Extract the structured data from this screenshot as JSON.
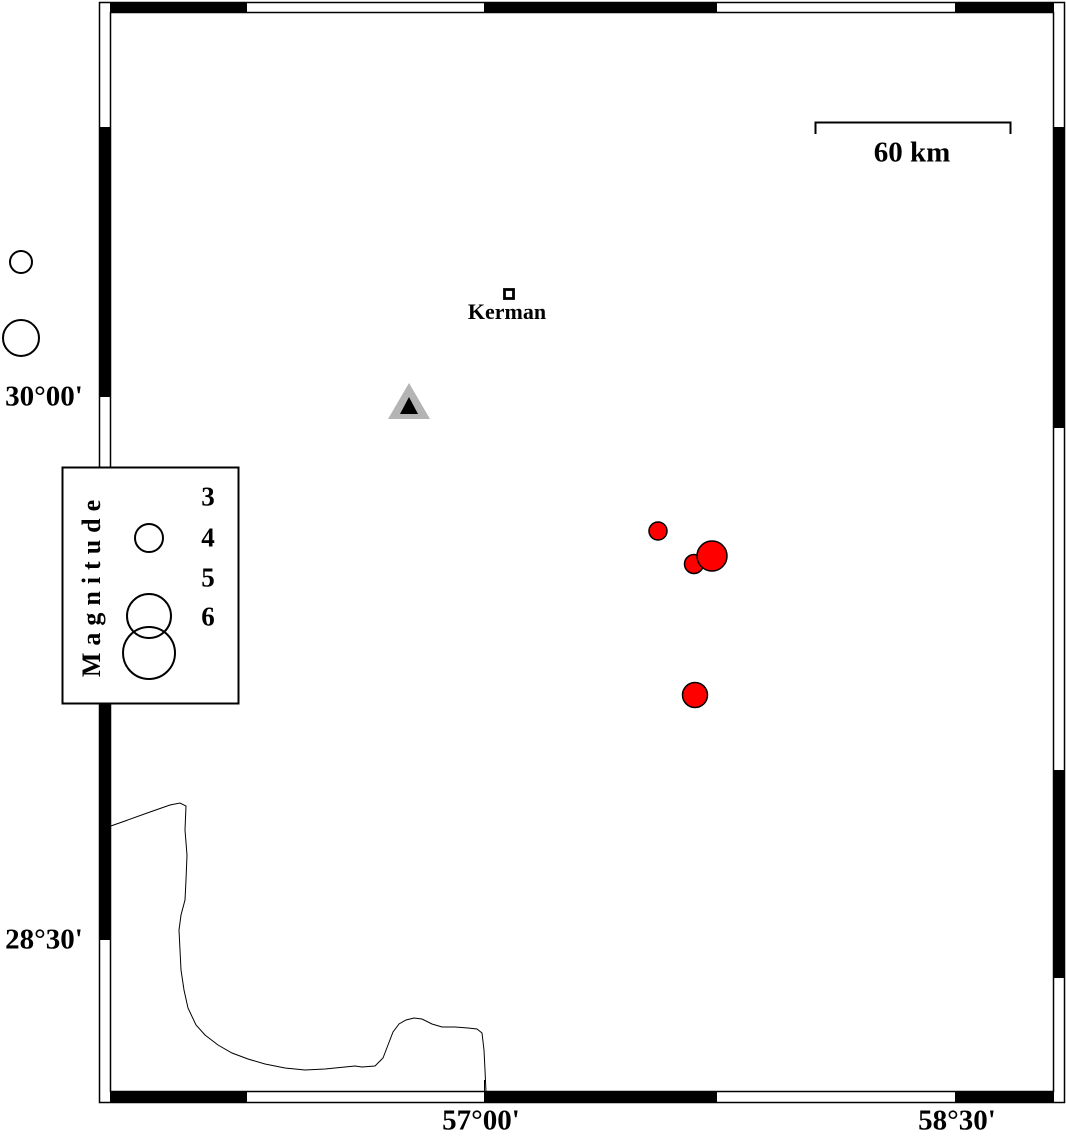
{
  "map": {
    "region_note": "seismicity map frame",
    "frame": {
      "inner": {
        "x": 110,
        "y": 12,
        "w": 944,
        "h": 1080
      },
      "outer": {
        "x": 99,
        "y": 2,
        "w": 966,
        "h": 1101
      }
    }
  },
  "axis": {
    "left_labels": [
      {
        "text": "30°00'",
        "x": 44,
        "y": 397
      },
      {
        "text": "28°30'",
        "x": 44,
        "y": 940
      }
    ],
    "bottom_labels": [
      {
        "text": "57°00'",
        "x": 481,
        "y": 1121
      },
      {
        "text": "58°30'",
        "x": 957,
        "y": 1121
      }
    ]
  },
  "scale_bar": {
    "label": "60 km",
    "label_pos": {
      "x": 912,
      "y": 153
    },
    "x1": 815,
    "x2": 1010,
    "y": 122,
    "tick_drop": 12
  },
  "city": {
    "name": "Kerman",
    "label": {
      "x": 507,
      "y": 312
    },
    "marker": {
      "x": 504.5,
      "y": 289.5,
      "size": 9
    }
  },
  "station": {
    "outer_points": "409,383 388,419 430,419",
    "inner_points": "409,397 400,414 418,414"
  },
  "legend": {
    "title": "Magnitude",
    "title_pos": {
      "x": 92,
      "y": 585
    },
    "box": {
      "x": 62.5,
      "y": 467.5,
      "w": 176,
      "h": 236
    },
    "entries": [
      {
        "label": "3",
        "x": 208,
        "y": 497
      },
      {
        "label": "4",
        "x": 208,
        "y": 538
      },
      {
        "label": "5",
        "x": 208,
        "y": 578
      },
      {
        "label": "6",
        "x": 208,
        "y": 617
      }
    ],
    "circles": [
      {
        "x": 149,
        "y": 538,
        "r": 14
      },
      {
        "x": 149,
        "y": 616,
        "r": 22
      },
      {
        "x": 149,
        "y": 653,
        "r": 26
      }
    ],
    "extra_circles": [
      {
        "x": 21,
        "y": 262,
        "r": 11
      },
      {
        "x": 21,
        "y": 338,
        "r": 18
      }
    ]
  },
  "earthquakes": [
    {
      "x": 658,
      "y": 531,
      "r": 9
    },
    {
      "x": 694,
      "y": 564,
      "r": 9.5
    },
    {
      "x": 712,
      "y": 556,
      "r": 15
    },
    {
      "x": 695,
      "y": 695,
      "r": 12.5
    }
  ],
  "coastline": [
    [
      108,
      827
    ],
    [
      125,
      821
    ],
    [
      150,
      812
    ],
    [
      170,
      805
    ],
    [
      180,
      803
    ],
    [
      186,
      806
    ],
    [
      185,
      830
    ],
    [
      187,
      855
    ],
    [
      186,
      880
    ],
    [
      185,
      900
    ],
    [
      181,
      915
    ],
    [
      179,
      930
    ],
    [
      180,
      950
    ],
    [
      181,
      970
    ],
    [
      184,
      990
    ],
    [
      188,
      1008
    ],
    [
      196,
      1025
    ],
    [
      205,
      1035
    ],
    [
      218,
      1045
    ],
    [
      232,
      1053
    ],
    [
      248,
      1059
    ],
    [
      265,
      1064
    ],
    [
      285,
      1068
    ],
    [
      305,
      1070
    ],
    [
      325,
      1069
    ],
    [
      345,
      1067
    ],
    [
      355,
      1066
    ],
    [
      362,
      1067
    ],
    [
      375,
      1066
    ],
    [
      383,
      1058
    ],
    [
      388,
      1045
    ],
    [
      393,
      1032
    ],
    [
      399,
      1024
    ],
    [
      406,
      1020
    ],
    [
      414,
      1018
    ],
    [
      422,
      1019
    ],
    [
      432,
      1024
    ],
    [
      442,
      1027
    ],
    [
      455,
      1027
    ],
    [
      468,
      1028
    ],
    [
      477,
      1029
    ],
    [
      482,
      1033
    ],
    [
      484,
      1050
    ],
    [
      485,
      1070
    ],
    [
      486,
      1092
    ]
  ],
  "colors": {
    "earthquake": "#ff0000",
    "station_outer": "#b4b4b4",
    "station_inner": "#000000",
    "frame": "#000000",
    "background": "#ffffff"
  }
}
